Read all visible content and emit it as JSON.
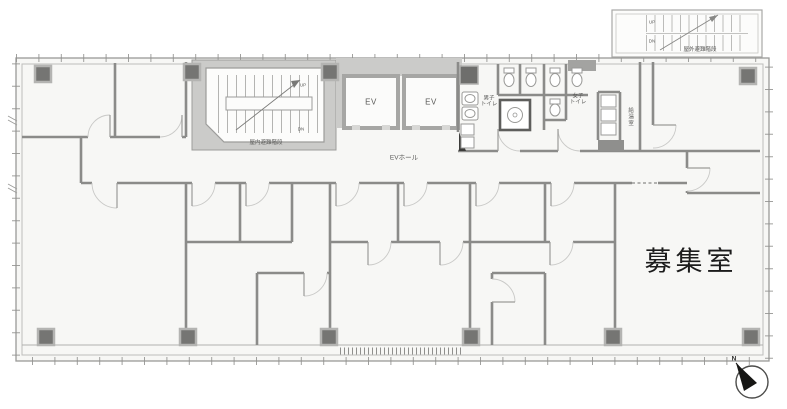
{
  "floorplan": {
    "vacant_room_label": "募集室",
    "elevators": {
      "ev1": "EV",
      "ev2": "EV",
      "hall": "EVホール"
    },
    "stairs": {
      "indoor": "屋内避難階段",
      "outdoor": "屋外避難階段",
      "up": "UP",
      "down": "DN"
    },
    "toilets": {
      "mens_line1": "男子",
      "mens_line2": "トイレ",
      "womens_line1": "女子",
      "womens_line2": "トイレ"
    },
    "kitchenette": "給湯室",
    "compass_north": "N",
    "colors": {
      "floor": "#f7f7f5",
      "wall": "#8b8b89",
      "core_fill": "#cbcbc9",
      "column": "#757573",
      "small_label_text": "#5a5a58",
      "room_label_text": "#1c1c1c"
    }
  }
}
